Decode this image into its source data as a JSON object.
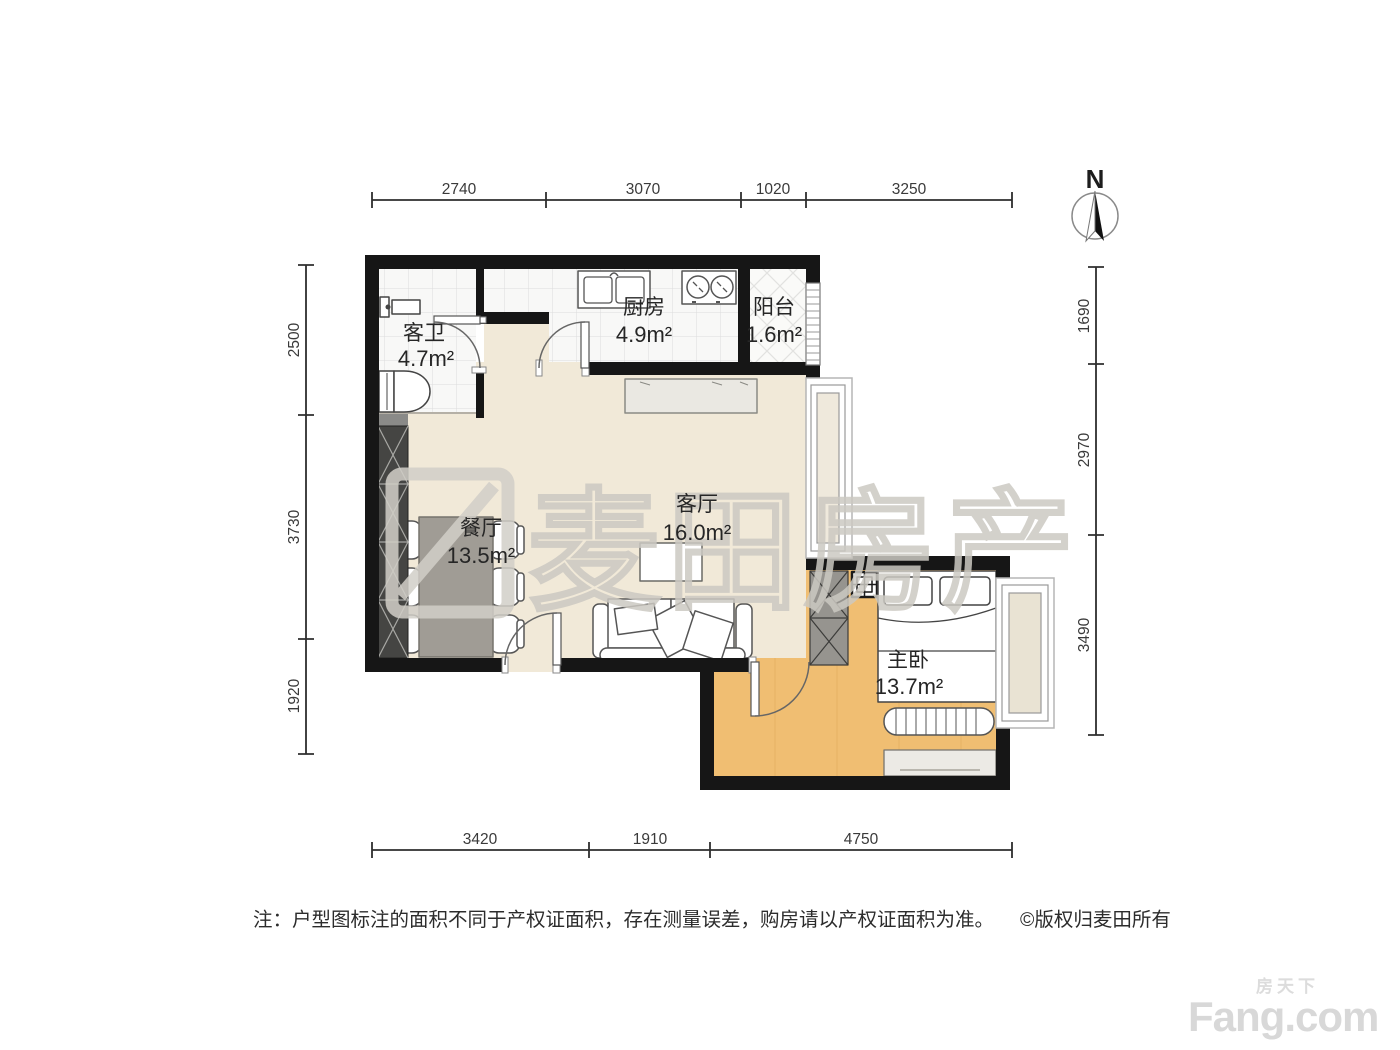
{
  "plan": {
    "watermark": "麦田房产",
    "compass": {
      "label": "N"
    },
    "rooms": [
      {
        "name": "客卫",
        "area": "4.7m²"
      },
      {
        "name": "厨房",
        "area": "4.9m²"
      },
      {
        "name": "阳台",
        "area": "1.6m²"
      },
      {
        "name": "餐厅",
        "area": "13.5m²"
      },
      {
        "name": "客厅",
        "area": "16.0m²"
      },
      {
        "name": "主卧",
        "area": "13.7m²"
      }
    ],
    "dimensions": {
      "top": [
        "2740",
        "3070",
        "1020",
        "3250"
      ],
      "bottom": [
        "3420",
        "1910",
        "4750"
      ],
      "left": [
        "2500",
        "3730",
        "1920"
      ],
      "right": [
        "1690",
        "2970",
        "3490"
      ]
    },
    "colors": {
      "wall": "#161616",
      "living_floor": "#f1e9d8",
      "bedroom_floor": "#f0be72",
      "tile_floor": "#f8f8f7"
    }
  },
  "footer": {
    "note": "注：户型图标注的面积不同于产权证面积，存在测量误差，购房请以产权证面积为准。",
    "copyright": "©版权归麦田所有"
  },
  "brand": {
    "cn": "房天下",
    "en": "Fang.com"
  }
}
